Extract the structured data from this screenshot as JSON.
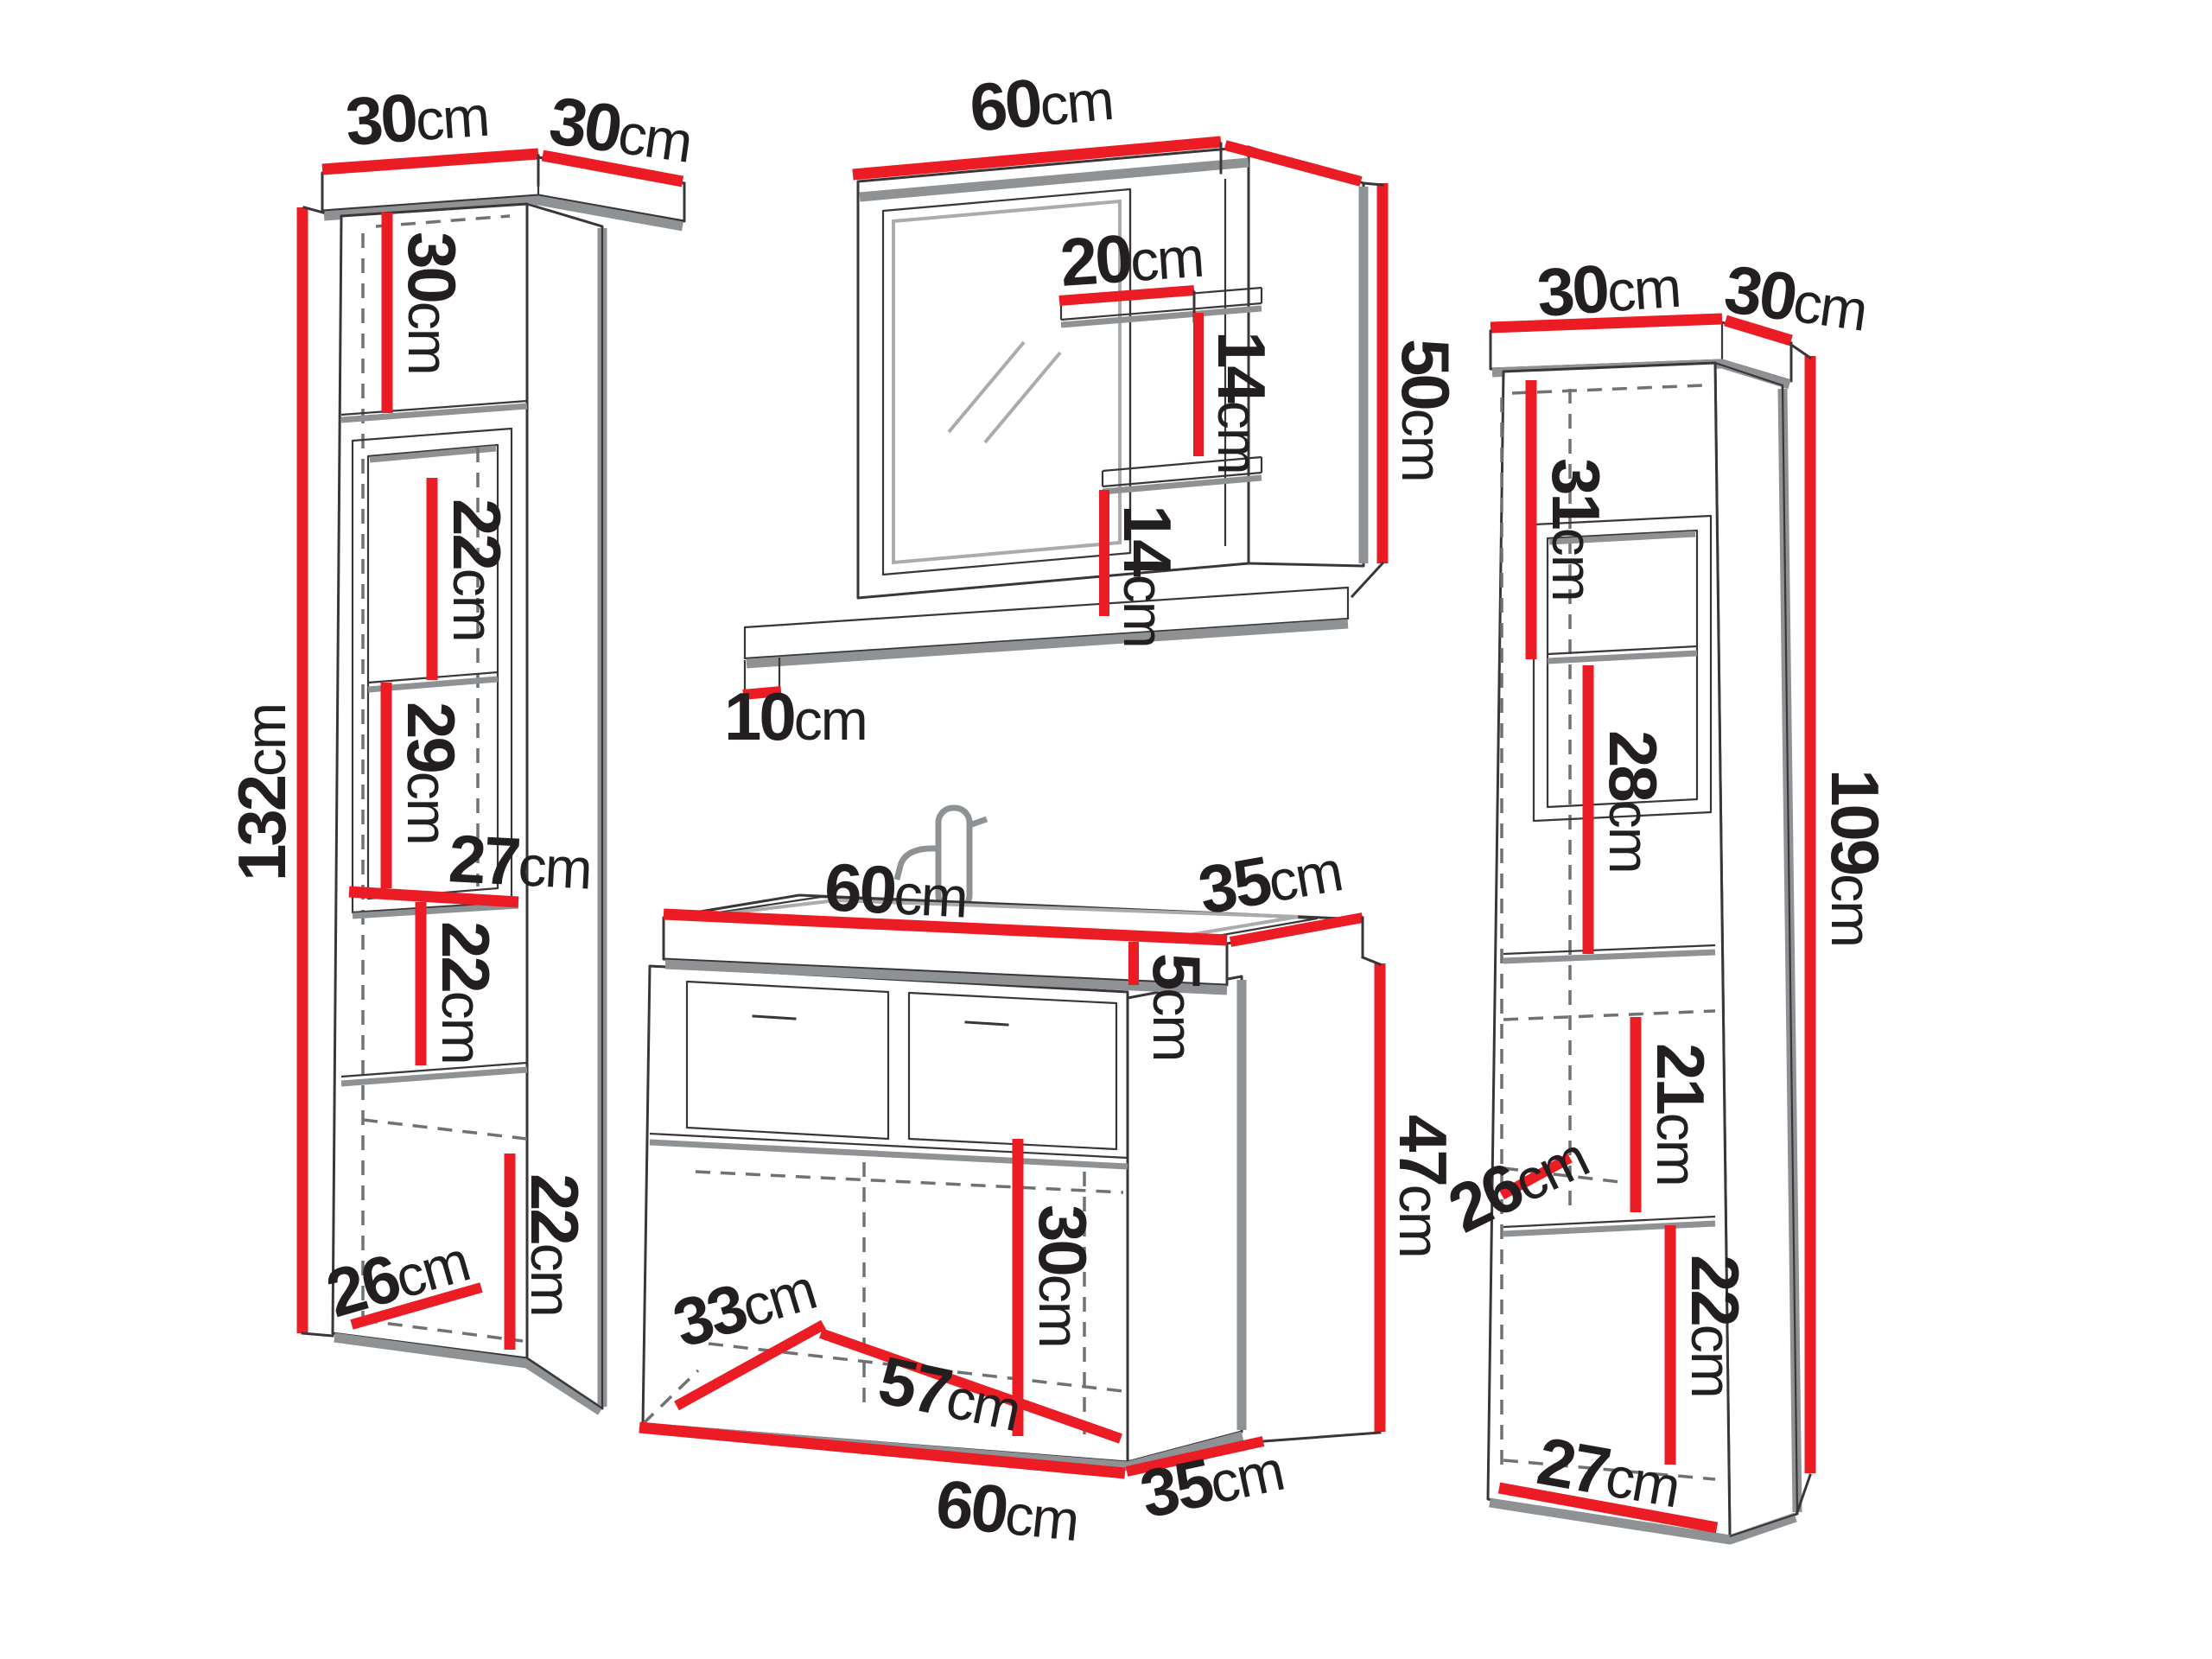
{
  "diagram_type": "bathroom-furniture-dimension-diagram",
  "unit": "cm",
  "colors": {
    "accent": "#ec1c24",
    "ink": "#231f20",
    "line_dark": "#3a3637",
    "line_gray": "#8f9295",
    "line_mid": "#a9abae",
    "line_dash": "#6f7173"
  },
  "left_cabinet": {
    "name": "tall cabinet 132cm",
    "top_width": {
      "num": "30",
      "unit": "cm"
    },
    "top_depth": {
      "num": "30",
      "unit": "cm"
    },
    "height": {
      "num": "132",
      "unit": "cm"
    },
    "section_1": {
      "num": "30",
      "unit": "cm"
    },
    "section_2": {
      "num": "22",
      "unit": "cm"
    },
    "section_3": {
      "num": "29",
      "unit": "cm"
    },
    "niche_width": {
      "num": "27",
      "unit": "cm"
    },
    "section_4": {
      "num": "22",
      "unit": "cm"
    },
    "section_5": {
      "num": "22",
      "unit": "cm"
    },
    "bottom_depth": {
      "num": "26",
      "unit": "cm"
    }
  },
  "mirror": {
    "name": "mirror cabinet 60x50cm",
    "width": {
      "num": "60",
      "unit": "cm"
    },
    "shelf_width": {
      "num": "20",
      "unit": "cm"
    },
    "shelf_gap_upper": {
      "num": "14",
      "unit": "cm"
    },
    "shelf_gap_lower": {
      "num": "14",
      "unit": "cm"
    },
    "height": {
      "num": "50",
      "unit": "cm"
    },
    "ledge_depth": {
      "num": "10",
      "unit": "cm"
    }
  },
  "vanity": {
    "name": "sink vanity 60x35x47cm",
    "top_width": {
      "num": "60",
      "unit": "cm"
    },
    "top_depth": {
      "num": "35",
      "unit": "cm"
    },
    "basin_height": {
      "num": "5",
      "unit": "cm"
    },
    "body_height": {
      "num": "47",
      "unit": "cm"
    },
    "interior_height": {
      "num": "30",
      "unit": "cm"
    },
    "interior_depth": {
      "num": "33",
      "unit": "cm"
    },
    "interior_width": {
      "num": "57",
      "unit": "cm"
    },
    "bottom_width": {
      "num": "60",
      "unit": "cm"
    },
    "bottom_depth": {
      "num": "35",
      "unit": "cm"
    }
  },
  "right_cabinet": {
    "name": "tall cabinet 109cm",
    "top_width": {
      "num": "30",
      "unit": "cm"
    },
    "top_depth": {
      "num": "30",
      "unit": "cm"
    },
    "height": {
      "num": "109",
      "unit": "cm"
    },
    "section_1": {
      "num": "31",
      "unit": "cm"
    },
    "section_2": {
      "num": "28",
      "unit": "cm"
    },
    "section_3": {
      "num": "21",
      "unit": "cm"
    },
    "niche_depth": {
      "num": "26",
      "unit": "cm"
    },
    "section_4": {
      "num": "22",
      "unit": "cm"
    },
    "bottom_width": {
      "num": "27",
      "unit": "cm"
    }
  }
}
